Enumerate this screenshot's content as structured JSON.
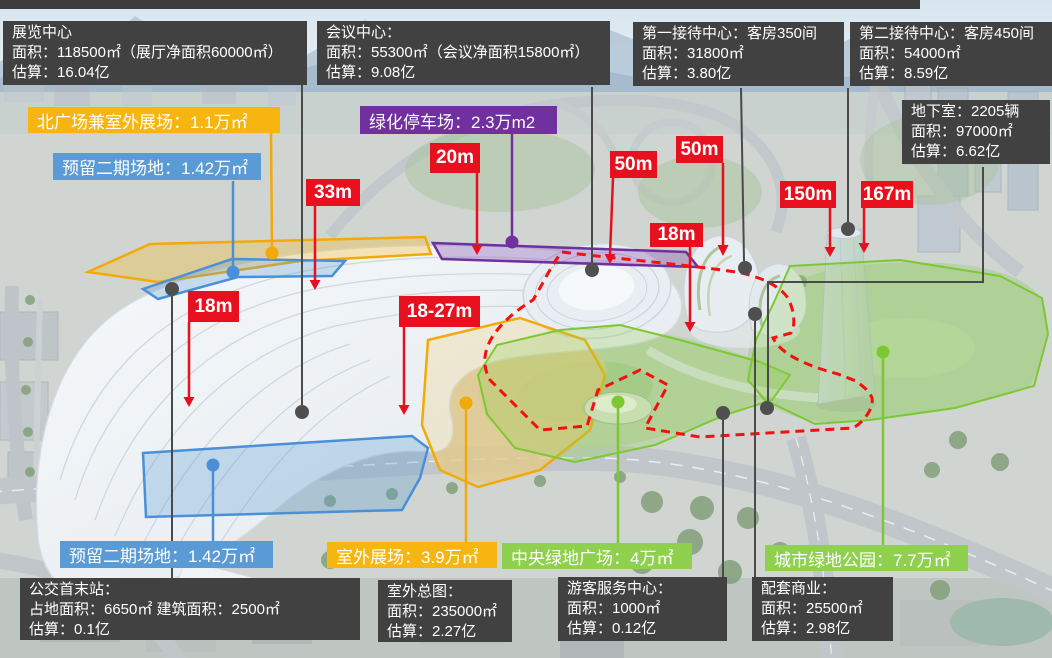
{
  "colors": {
    "info_box_bg": "#414141",
    "red": "#E8101E",
    "yellow": "#F7B512",
    "blue": "#5B9BD5",
    "purple": "#7030A0",
    "green": "#8FD14F",
    "leader_dark": "#4A4A4A",
    "leader_yellow": "#F2A90A",
    "leader_blue": "#4A90D9",
    "leader_purple": "#7030A0",
    "leader_green": "#7DC832",
    "dashed_red": "#F50F0F"
  },
  "info_boxes": [
    {
      "id": "exhibition-center",
      "lines": [
        "展览中心",
        "面积：118500㎡（展厅净面积60000㎡）",
        "估算：16.04亿"
      ]
    },
    {
      "id": "conference-center",
      "lines": [
        "会议中心：",
        "面积：55300㎡（会议净面积15800㎡）",
        "估算：9.08亿"
      ]
    },
    {
      "id": "first-reception-center",
      "lines": [
        "第一接待中心：客房350间",
        "面积：31800㎡",
        "估算：3.80亿"
      ]
    },
    {
      "id": "second-reception-center",
      "lines": [
        "第二接待中心：客房450间",
        "面积：54000㎡",
        "估算：8.59亿"
      ]
    },
    {
      "id": "basement",
      "lines": [
        "地下室：2205辆",
        "面积：97000㎡",
        "估算：6.62亿"
      ]
    },
    {
      "id": "bus-terminal",
      "lines": [
        "公交首末站：",
        "占地面积：6650㎡ 建筑面积：2500㎡",
        "估算：0.1亿"
      ]
    },
    {
      "id": "outdoor-master-plan",
      "lines": [
        "室外总图：",
        "面积：235000㎡",
        "估算：2.27亿"
      ]
    },
    {
      "id": "visitor-service-center",
      "lines": [
        "游客服务中心：",
        "面积：1000㎡",
        "估算：0.12亿"
      ]
    },
    {
      "id": "supporting-commercial",
      "lines": [
        "配套商业：",
        "面积：25500㎡",
        "估算：2.98亿"
      ]
    }
  ],
  "area_tags": [
    {
      "id": "north-plaza",
      "label": "北广场兼室外展场：1.1万㎡"
    },
    {
      "id": "reserved-phase2-north",
      "label": "预留二期场地：1.42万㎡"
    },
    {
      "id": "green-parking",
      "label": "绿化停车场：2.3万m2"
    },
    {
      "id": "reserved-phase2-south",
      "label": "预留二期场地：1.42万㎡"
    },
    {
      "id": "outdoor-exhibition",
      "label": "室外展场：3.9万㎡"
    },
    {
      "id": "central-green-plaza",
      "label": "中央绿地广场：4万㎡"
    },
    {
      "id": "city-green-park",
      "label": "城市绿地公园：7.7万㎡"
    }
  ],
  "dimension_tags": [
    {
      "id": "h33",
      "label": "33m"
    },
    {
      "id": "h20",
      "label": "20m"
    },
    {
      "id": "h50-west",
      "label": "50m"
    },
    {
      "id": "h50-east",
      "label": "50m"
    },
    {
      "id": "h18-hotel",
      "label": "18m"
    },
    {
      "id": "h150",
      "label": "150m"
    },
    {
      "id": "h167",
      "label": "167m"
    },
    {
      "id": "h18-hall",
      "label": "18m"
    },
    {
      "id": "h18-27",
      "label": "18-27m"
    }
  ]
}
